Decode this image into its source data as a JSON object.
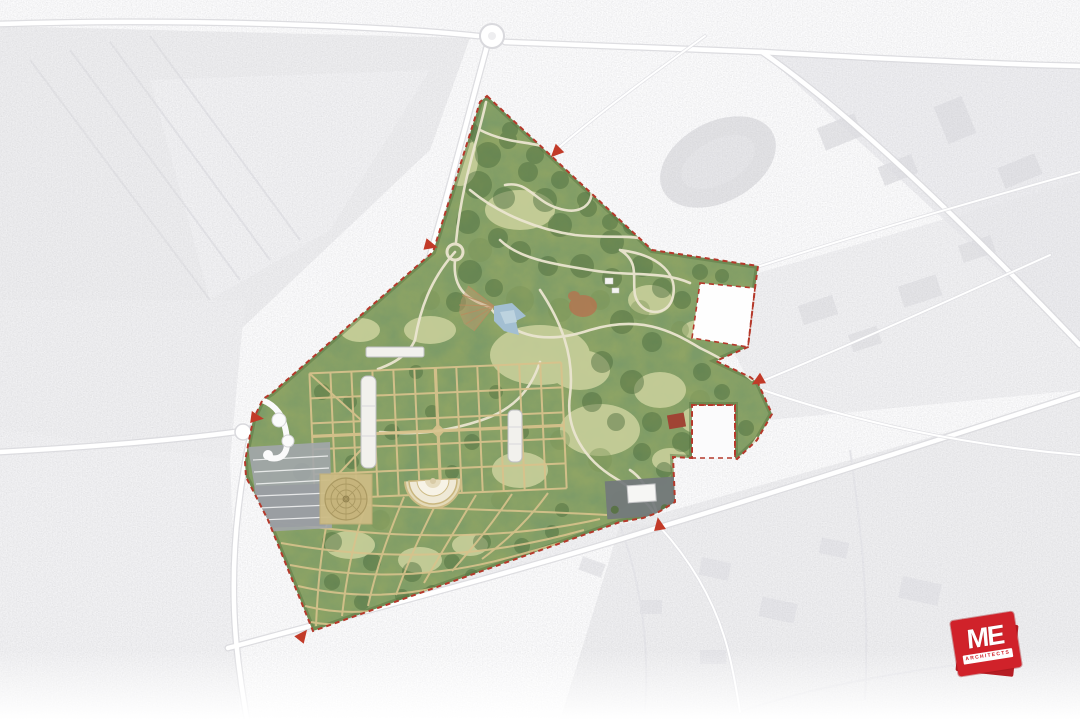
{
  "canvas": {
    "width": 1080,
    "height": 720
  },
  "logo": {
    "initials": "ME",
    "subtitle": "ARCHITECTS",
    "brand_color": "#d0222a"
  },
  "map": {
    "kind": "landscape-masterplan-aerial",
    "palette": {
      "park_green": "#8ea465",
      "tree_green": "#4b6a3c",
      "lawn_green": "#ccd29e",
      "path_cream": "#ebe5d0",
      "path_tan": "#d8c28c",
      "boundary_red": "#b5392b",
      "arrow_red": "#c23a28",
      "water_blue": "#a3bfd2",
      "clay_brown": "#b57450",
      "parking_grey": "#a2a6ab",
      "faded_aerial": "#ededf0"
    },
    "features": [
      {
        "id": "site-boundary",
        "label": "Red dashed site boundary"
      },
      {
        "id": "entrance-arrow",
        "label": "Entrance arrow",
        "count": 6
      },
      {
        "id": "woodland-park",
        "label": "Woodland park with winding paths"
      },
      {
        "id": "formal-garden-grid",
        "label": "Formal garden path grid"
      },
      {
        "id": "garden-fan-grid",
        "label": "Curved fan garden grid (south wedge)"
      },
      {
        "id": "greenhouse-building",
        "label": "White greenhouse building",
        "count": 3
      },
      {
        "id": "circular-parterre",
        "label": "Circular parterre garden"
      },
      {
        "id": "amphitheatre",
        "label": "Semicircular amphitheatre"
      },
      {
        "id": "parking-lot",
        "label": "Parking lot with bays"
      },
      {
        "id": "entrance-plaza",
        "label": "West entrance plaza loop"
      },
      {
        "id": "pond",
        "label": "Pond with radiating path fan"
      },
      {
        "id": "clay-play-area",
        "label": "Clay-coloured clearing"
      },
      {
        "id": "excluded-parcel",
        "label": "Excluded white parcel",
        "count": 2
      },
      {
        "id": "service-yard",
        "label": "Service yard with depot building"
      },
      {
        "id": "red-roof-building",
        "label": "Red roofed building"
      },
      {
        "id": "road-roundabout",
        "label": "Roundabout",
        "count": 2
      },
      {
        "id": "stadium-oval",
        "label": "Faded stadium oval (context)"
      }
    ]
  }
}
